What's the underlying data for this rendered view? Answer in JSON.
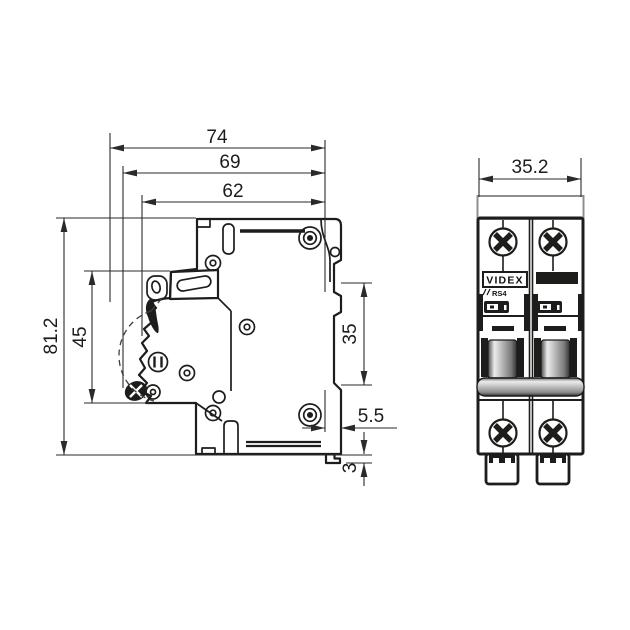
{
  "drawing": {
    "subject": "2-pole miniature circuit breaker, dimensional drawing (side and front views)",
    "colors": {
      "background": "#ffffff",
      "line": "#1d1d1b",
      "dimension": "#2a2a2a",
      "clip_outline_gray": "#8f8f8f",
      "handle_light": "#ececec",
      "handle_mid": "#a8a8a8",
      "handle_dark": "#373737"
    }
  },
  "side_view": {
    "dim_overall_depth": "74",
    "dim_depth_to_terminal": "69",
    "dim_body_depth": "62",
    "dim_overall_height": "81.2",
    "dim_front_section_height": "45",
    "dim_din_recess_height": "35",
    "dim_din_clip_depth": "5.5",
    "dim_clip_lip_height": "3"
  },
  "front_view": {
    "dim_width": "35.2",
    "brand": "VIDEX",
    "series": "RS4"
  }
}
